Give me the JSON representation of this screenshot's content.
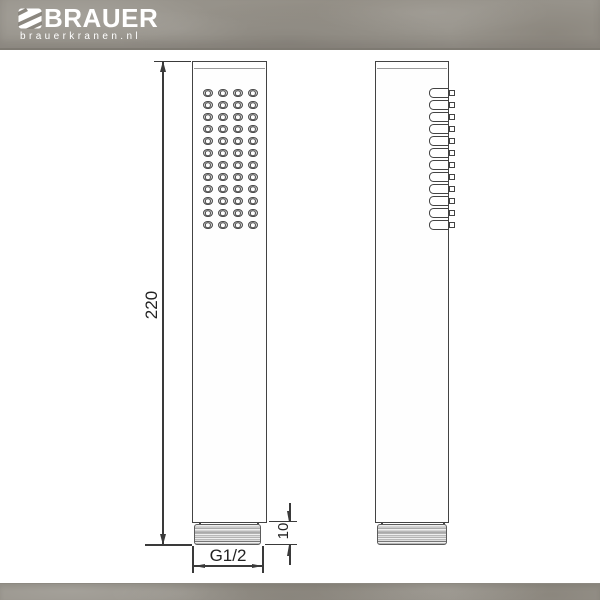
{
  "brand": {
    "name": "BRAUER",
    "website": "brauerkranen.nl"
  },
  "drawing": {
    "type": "technical-dimension-drawing",
    "views": [
      {
        "id": "front-view",
        "nozzle_rows": 12,
        "nozzle_cols": 4
      },
      {
        "id": "side-view",
        "nozzle_rows": 12
      }
    ],
    "dimensions": [
      {
        "id": "overall-length",
        "label": "220",
        "orientation": "vertical"
      },
      {
        "id": "thread-length",
        "label": "10",
        "orientation": "vertical"
      },
      {
        "id": "thread-size",
        "label": "G1/2",
        "orientation": "horizontal"
      }
    ]
  },
  "colors": {
    "line": "#3a3a3a",
    "band": "#98948c",
    "paper": "#ffffff",
    "thread_fill": "#d9d9d9"
  }
}
